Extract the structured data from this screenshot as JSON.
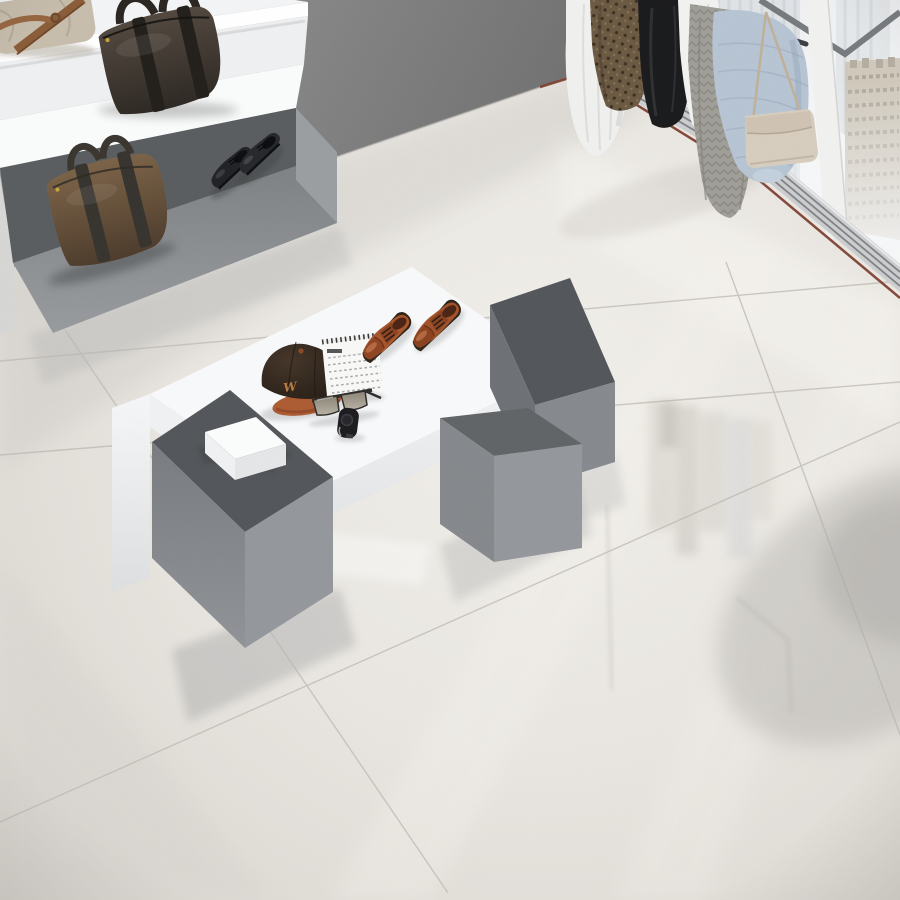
{
  "scene": {
    "description": "Menswear showroom corner with glossy large-format porcelain tile floor, white and grey display plinths with leather accessories, stepped wall shelves with bags, a clothing rail and a floor-to-ceiling window with a hazy city skyline",
    "objects": [
      "beige canvas bag",
      "espresso leather holdall",
      "brown leather duffel bag",
      "black derby shoes",
      "cognac oxford shoes",
      "baseball cap with W monogram",
      "desk flip calendar",
      "sunglasses",
      "black wristwatch",
      "white gift box",
      "white display platform",
      "grey display cubes",
      "grey display bench",
      "white stepped shelves",
      "clothing rail with garments",
      "beige crossbody bag",
      "window with skyscraper view",
      "glossy tile floor with reflections"
    ]
  },
  "cap": {
    "monogram": "W"
  },
  "colors": {
    "floor": "#e9e6e1",
    "grout": "#bcb8b2",
    "wall_dark": "#7f7f7f",
    "shelf_white": "#f3f4f5",
    "shelf_edge_white": "#ffffff",
    "bench_top": "#5a5d60",
    "bench_end": "#9a9ea1",
    "cube_top": "#53565a",
    "platform_white": "#f8f9fa",
    "panel_white": "#f3f4f5",
    "box_white": "#fbfcfc",
    "beige_bag": "#c7bdac",
    "beige_bag_strap": "#8a5c38",
    "derby_black": "#212226",
    "oxford_cognac": "#a8552c",
    "oxford_toe": "#8f4523",
    "cap_crown": "#2f2620",
    "cap_brim": "#ad5c33",
    "cap_monogram": "#b97a40",
    "calendar_white": "#f8f8f7",
    "sunglasses_frame": "#2f2d2a",
    "lens_gray": "#948d80",
    "watch_black": "#1c1c1f",
    "rail_dark": "#3c3f42",
    "dress_white": "#f0f0ef",
    "leopard_brown": "#6b5942",
    "jacket_black": "#1a1b1d",
    "shirt_white": "#f2f2f1",
    "cardigan_gray": "#a09e99",
    "sweater_blue": "#b6c4d3",
    "hangbag_beige": "#d7cdbe",
    "sill_gray": "#cbcdcf",
    "trim_red": "#7d3f30",
    "city_tower": "#dfe3e6",
    "city_beige": "#cfc8bb"
  }
}
